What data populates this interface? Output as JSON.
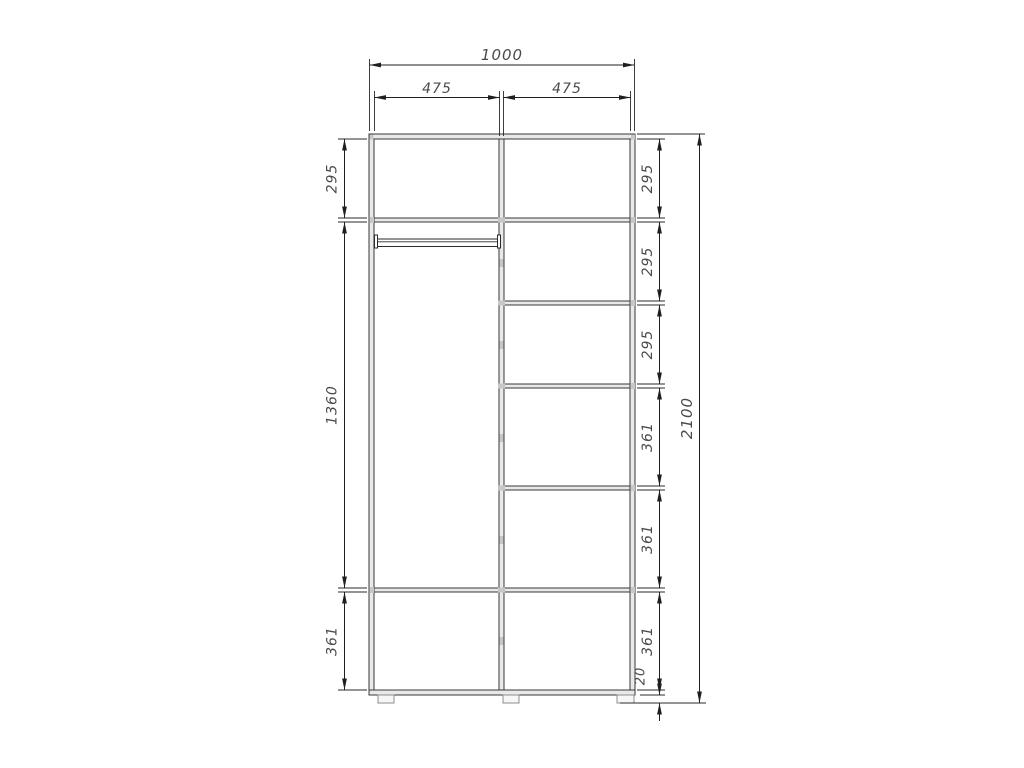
{
  "drawing": {
    "colors": {
      "background": "#ffffff",
      "dimension_line": "#1f1f1f",
      "panel_fill": "#e9e9e9",
      "panel_stroke": "#383838",
      "dimension_text": "#4a4a4a",
      "joint_mark": "#c7c7c7"
    },
    "dimensions": {
      "width_total": "1000",
      "width_left_section": "475",
      "width_right_section": "475",
      "height_total": "2100",
      "plinth_height": "20",
      "left_sections": [
        "295",
        "1360",
        "361"
      ],
      "right_sections": [
        "295",
        "295",
        "295",
        "361",
        "361",
        "361"
      ]
    }
  }
}
